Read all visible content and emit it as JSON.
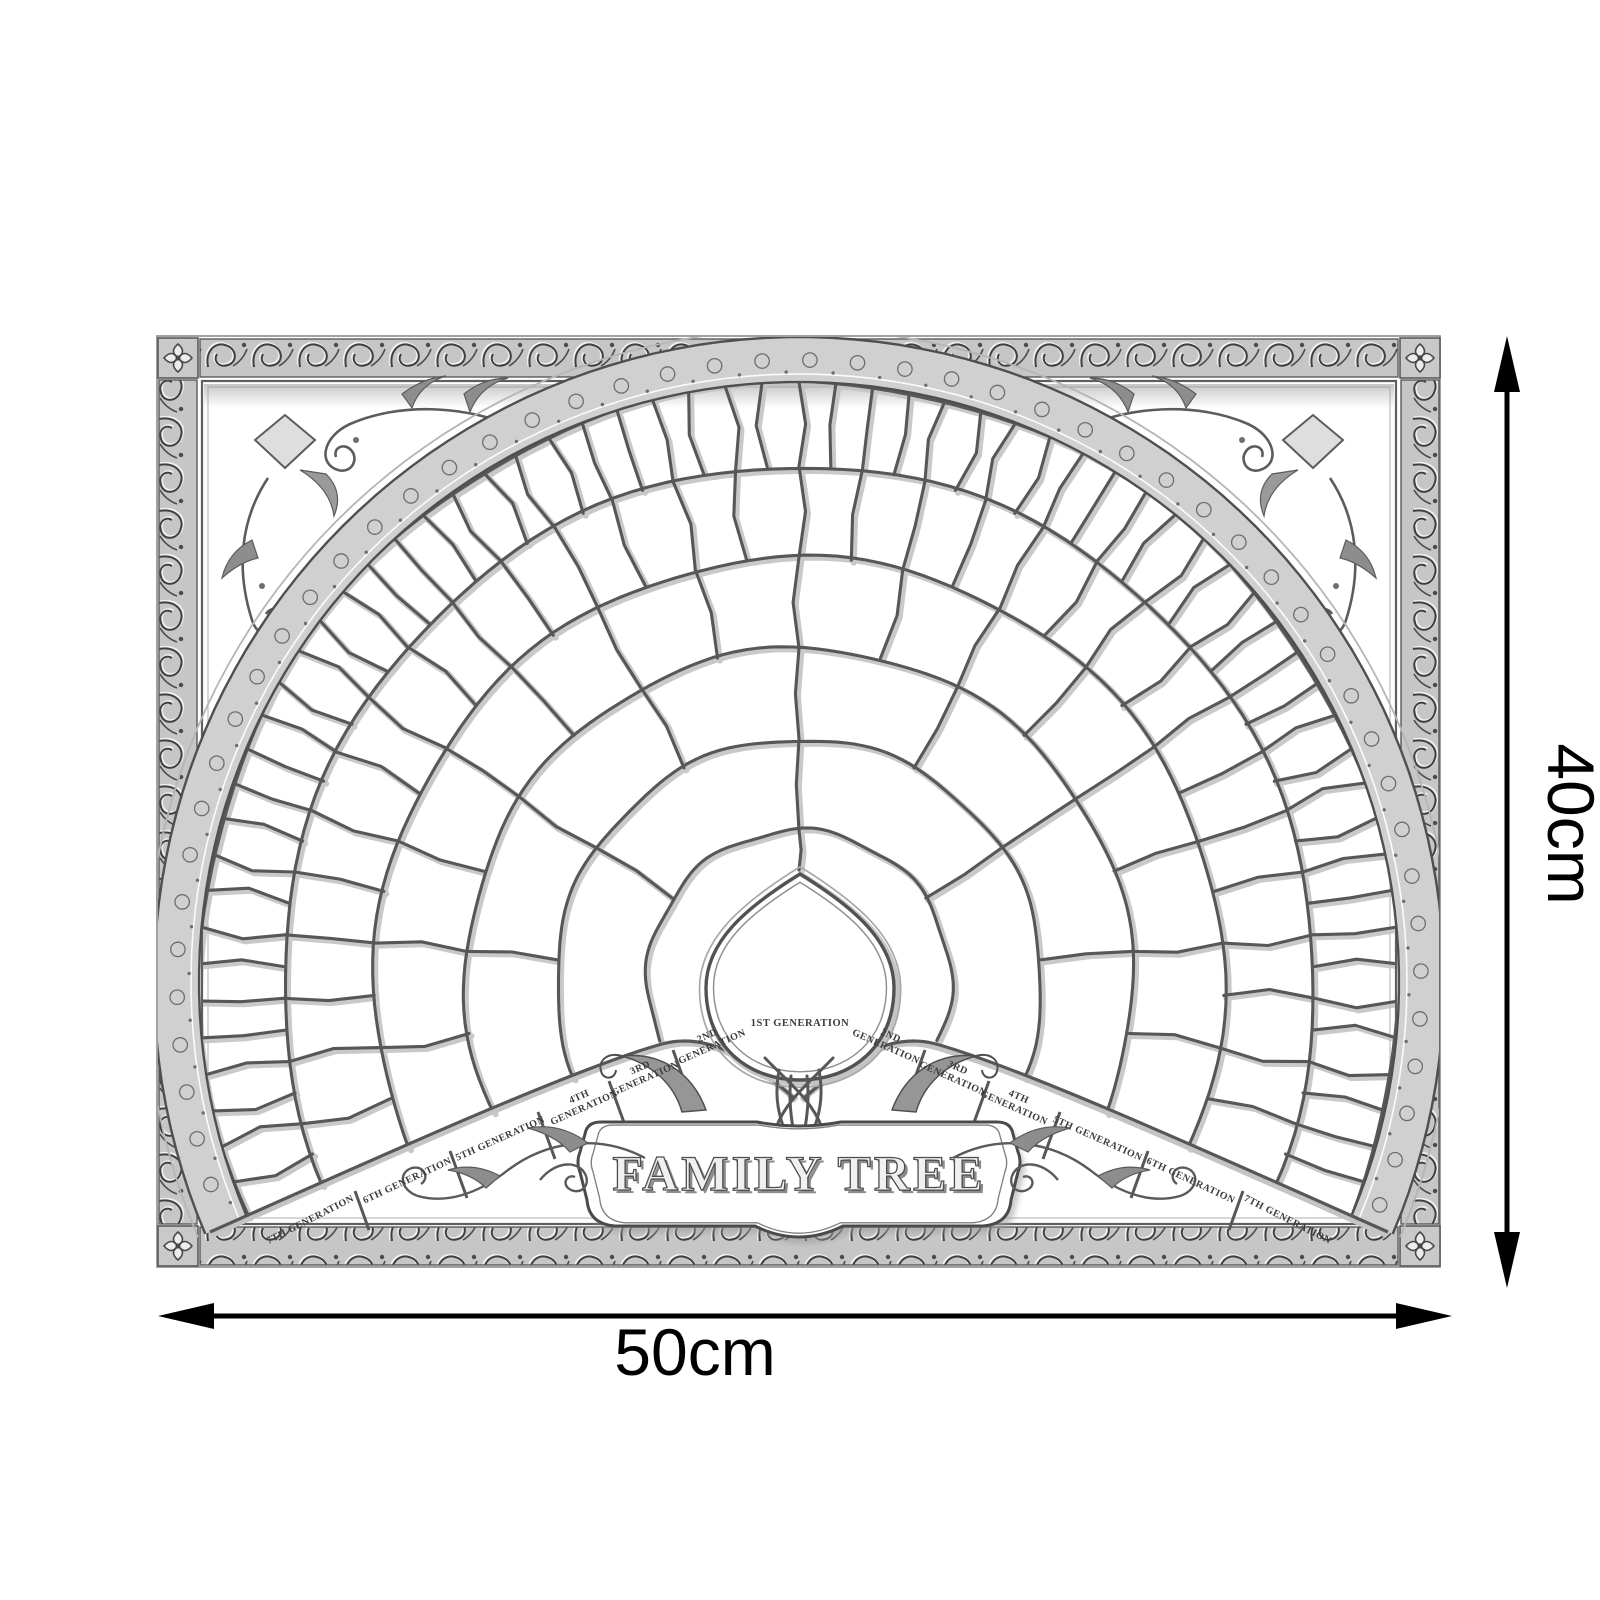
{
  "poster": {
    "title": "FAMILY TREE",
    "center_label": "1ST GENERATION",
    "generation_labels": [
      "2ND GENERATION",
      "3RD GENERATION",
      "4TH GENERATION",
      "5TH GENERATION",
      "6TH GENERATION",
      "7TH GENERATION"
    ],
    "two_line_count": 3,
    "structure": {
      "type": "fan-genealogy-chart",
      "generations": 7,
      "cells_per_generation": [
        1,
        2,
        4,
        8,
        16,
        32,
        64
      ],
      "span_degrees": 226
    },
    "colors": {
      "ink": "#575757",
      "band": "#c6c6c6",
      "paper": "#ffffff",
      "label_ink": "#3c3c3c"
    }
  },
  "dimensions": {
    "height_label": "40cm",
    "width_label": "50cm",
    "color": "#000000"
  }
}
